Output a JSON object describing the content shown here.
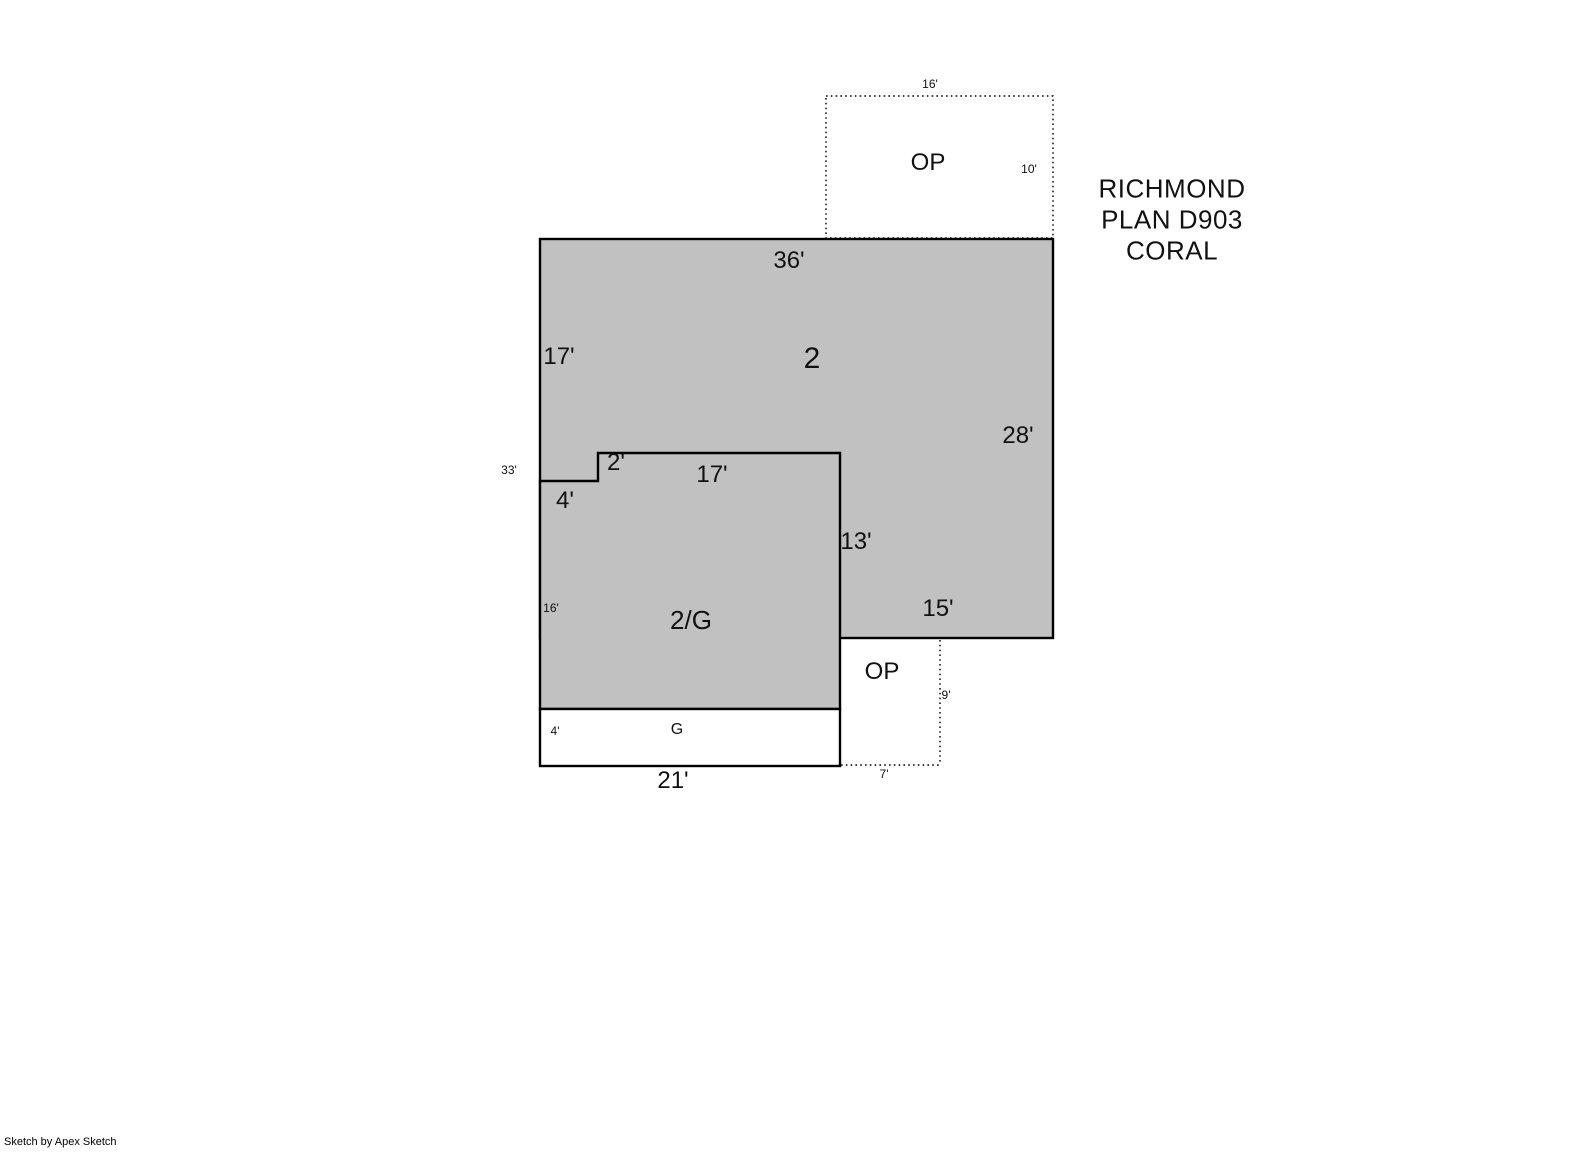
{
  "title": {
    "line1": "RICHMOND",
    "line2": "PLAN D903",
    "line3": "CORAL"
  },
  "areas": {
    "main_label": "2",
    "lower_label": "2/G",
    "garage_label": "G",
    "porch_top_label": "OP",
    "porch_bottom_label": "OP"
  },
  "dims": {
    "porch_top_width": "16'",
    "porch_top_depth": "10'",
    "main_top_width": "36'",
    "main_left_height": "17'",
    "main_right_height": "28'",
    "left_total_height": "33'",
    "step_height": "2'",
    "lower_top_width": "17'",
    "step_width": "4'",
    "lower_right_height": "13'",
    "main_bottom_right_width": "15'",
    "lower_left_height": "16'",
    "garage_left_height": "4'",
    "bottom_width": "21'",
    "porch_bottom_depth": "9'",
    "porch_bottom_width": "7'"
  },
  "footer": {
    "credit": "Sketch by Apex Sketch"
  },
  "colors": {
    "area_fill": "#c1c1c1",
    "outline": "#000000",
    "background": "#ffffff"
  }
}
